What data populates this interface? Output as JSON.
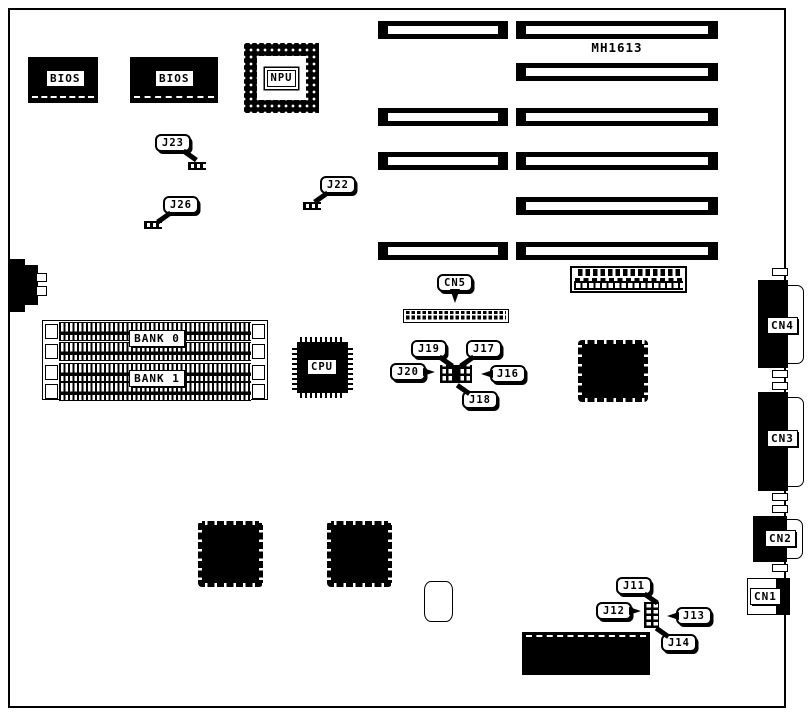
{
  "board": {
    "model": "MH1613",
    "bg_color": "#ffffff",
    "line_color": "#000000"
  },
  "chips": {
    "bios_left": {
      "label": "BIOS"
    },
    "bios_right": {
      "label": "BIOS"
    },
    "npu": {
      "label": "NPU"
    },
    "cpu": {
      "label": "CPU"
    }
  },
  "memory": {
    "bank0": {
      "label": "BANK 0"
    },
    "bank1": {
      "label": "BANK 1"
    }
  },
  "connectors": {
    "cn1": {
      "label": "CN1"
    },
    "cn2": {
      "label": "CN2"
    },
    "cn3": {
      "label": "CN3"
    },
    "cn4": {
      "label": "CN4"
    },
    "cn5": {
      "label": "CN5"
    }
  },
  "jumpers": {
    "j11": {
      "label": "J11"
    },
    "j12": {
      "label": "J12"
    },
    "j13": {
      "label": "J13"
    },
    "j14": {
      "label": "J14"
    },
    "j16": {
      "label": "J16"
    },
    "j17": {
      "label": "J17"
    },
    "j18": {
      "label": "J18"
    },
    "j19": {
      "label": "J19"
    },
    "j20": {
      "label": "J20"
    },
    "j22": {
      "label": "J22"
    },
    "j23": {
      "label": "J23"
    },
    "j26": {
      "label": "J26"
    }
  }
}
